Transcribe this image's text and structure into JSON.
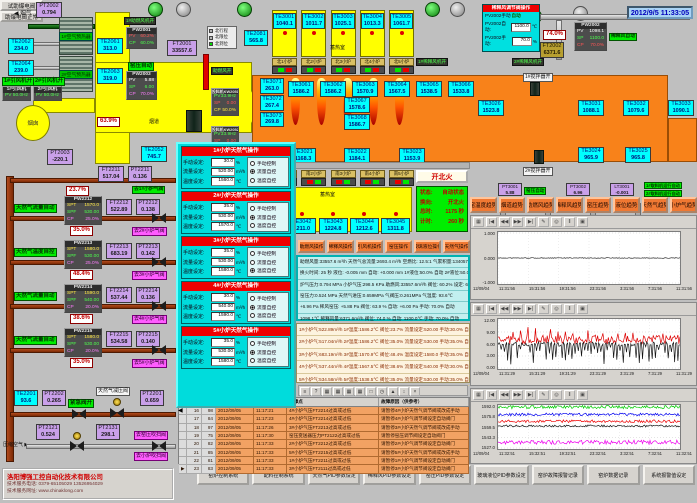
{
  "datetime": "2012/9/5 11:33:05",
  "top_left": {
    "pt2002": {
      "tag": "PT2002",
      "value": "0.794"
    },
    "smoke": "烟气",
    "exchanger1": "1#空气预热器",
    "exchanger2": "2#空气预热器",
    "te2062": {
      "tag": "TE2062",
      "value": "234.0"
    },
    "te2061": {
      "tag": "TE2061",
      "value": "313.0"
    },
    "te2064": {
      "tag": "TE2064",
      "value": "239.0"
    },
    "te2063": {
      "tag": "TE2063",
      "value": "319.0"
    },
    "fan1_run": "1#引风机开",
    "fan2_run": "2#引风机开",
    "fan1": {
      "title": "1#引风机",
      "k": "PV",
      "v": "50.0Hz"
    },
    "fan2": {
      "title": "2#引风机",
      "k": "PV",
      "v": "50.0Hz"
    },
    "chimney": "烟囱",
    "pt2003": {
      "tag": "PT2003",
      "value": "-220.1"
    },
    "comb_fan_run": "1#助燃风机开",
    "pw2001": {
      "title": "PW2001",
      "k1": "PV",
      "v1": "60.2%",
      "k2": "CP",
      "v2": "60.0%"
    },
    "kiln_auto": "窑压自动",
    "pw2003": {
      "title": "PW2003",
      "k1": "PV",
      "v1": "5.88",
      "k2": "SP",
      "v2": "6.00",
      "k3": "CP",
      "v3": "70.0%"
    },
    "ft2001": {
      "tag": "FT2001",
      "value": "33557.6"
    },
    "te2081": {
      "tag": "TE2081",
      "value": "565.8"
    },
    "damper": "63.9%",
    "flue": "烟道",
    "te2052": {
      "tag": "TE2052",
      "value": "745.7"
    },
    "legend": [
      {
        "label": "北行程",
        "c": "sq-gray"
      },
      {
        "label": "北限位",
        "c": "sq-gray"
      },
      {
        "label": "北到位",
        "c": "sq-green"
      }
    ],
    "comb_open": "助燃风开",
    "feeder1": {
      "title": "投料机KW2051",
      "k1": "PV",
      "v1": "33.9Hz",
      "k2": "SP",
      "v2": "0.00",
      "k3": "CP",
      "v3": "50.0%"
    },
    "feeder2": {
      "title": "投料机KW2052",
      "k1": "PV",
      "v1": "33.9Hz",
      "k2": "SP",
      "v2": "0.00",
      "k3": "CP",
      "v3": "50.0%"
    }
  },
  "furnace": {
    "regen_label": "蓄热室",
    "regen_top": [
      {
        "tag": "TE3001",
        "value": "1040.1"
      },
      {
        "tag": "TE3002",
        "value": "1011.7"
      },
      {
        "tag": "TE3003",
        "value": "1025.1"
      },
      {
        "tag": "TE3004",
        "value": "1013.3"
      },
      {
        "tag": "TE3005",
        "value": "1061.7"
      }
    ],
    "ports_north": [
      "北1小炉",
      "北2小炉",
      "北3小炉",
      "北4小炉",
      "北5小炉"
    ],
    "ports_south": [
      "南1小炉",
      "南2小炉",
      "南3小炉",
      "南4小炉",
      "南5小炉"
    ],
    "te_left": [
      {
        "tag": "TE3071",
        "value": "263.0"
      },
      {
        "tag": "TE3072",
        "value": "267.4"
      },
      {
        "tag": "TE3073",
        "value": "269.8"
      }
    ],
    "te_row": [
      {
        "tag": "TE3061",
        "value": "1586.2"
      },
      {
        "tag": "TE3062",
        "value": "1586.2"
      },
      {
        "tag": "TE3063",
        "value": "1570.9"
      },
      {
        "tag": "TE3064",
        "value": "1567.5"
      },
      {
        "tag": "TE3065",
        "value": "1538.5"
      },
      {
        "tag": "TE3066",
        "value": "1533.8"
      }
    ],
    "te_stack": [
      {
        "tag": "TE3067",
        "value": "1578.6"
      },
      {
        "tag": "TE3068",
        "value": "1586.7"
      }
    ],
    "te_right": [
      {
        "tag": "TE3026",
        "value": "1523.8"
      },
      {
        "tag": "TE3031",
        "value": "1088.1"
      },
      {
        "tag": "TE3032",
        "value": "1079.6"
      },
      {
        "tag": "TE3033",
        "value": "1090.1"
      }
    ],
    "te3024": {
      "tag": "TE3024",
      "value": "965.9"
    },
    "te3025": {
      "tag": "TE3025",
      "value": "965.8"
    },
    "te_low": [
      {
        "tag": "TE3021",
        "value": "1168.3"
      },
      {
        "tag": "TE3022",
        "value": "1184.1"
      },
      {
        "tag": "TE3023",
        "value": "1153.9"
      }
    ],
    "regen_bottom": [
      {
        "tag": "TE3041",
        "value": "1209.6"
      },
      {
        "tag": "TE3042",
        "value": "1211.0"
      },
      {
        "tag": "TE3043",
        "value": "1224.8"
      },
      {
        "tag": "TE3044",
        "value": "1212.6"
      },
      {
        "tag": "TE3045",
        "value": "1311.8"
      }
    ],
    "fire_btn": "开北火",
    "status": [
      {
        "k": "状态:",
        "v": "自动状态"
      },
      {
        "k": "换向:",
        "v": "开北火"
      },
      {
        "k": "总时:",
        "v": "1175 秒"
      },
      {
        "k": "计时:",
        "v": "260 秒"
      }
    ],
    "dilution1_run": "1#稀释风机开",
    "dilution2_run": "2#稀释风机开",
    "stir1": "1#搅拌器开",
    "stir2": "2#搅拌器开",
    "pt3001": {
      "tag": "PT3001",
      "value": "5.88"
    },
    "pt3002": {
      "tag": "PT3002",
      "value": "6.96"
    },
    "lt3001": {
      "tag": "LT3001",
      "value": "-0.001"
    },
    "kiln_auto2": "窑压自动",
    "taker1": "1#取料机运行自动",
    "taker2": "2#取料机运行自动"
  },
  "dilution": {
    "title": "稀释风调节阀操作",
    "mode_label": "PV2002手动",
    "mode_value": "自动",
    "auto_label": "PV2002自动:",
    "auto_value": "1100.0",
    "auto_unit": "℃",
    "man_label": "PV2002手动:",
    "man_value": "70.0",
    "man_unit": "%",
    "pct": "74.0%",
    "ft2002": {
      "tag": "FT2002",
      "value": "6371.6"
    },
    "pw2002": {
      "title": "PW2002",
      "k1": "PV",
      "v1": "1098.1",
      "k2": "SP",
      "v2": "1100.0",
      "k3": "CP",
      "v3": "70.0%"
    },
    "auto_tag": "稀释风自动",
    "btn_test": "试助爆电阀",
    "btn_ok": "助爆电阀正常"
  },
  "gas": {
    "line1": {
      "ft": {
        "tag": "FT2211",
        "value": "517.04"
      },
      "pt": {
        "tag": "PT2211",
        "value": "0.136"
      },
      "dest": "去1#小炉气阀",
      "pct_top": "23.7%"
    },
    "rows": [
      {
        "label": "天然气流量自动",
        "stack": {
          "title": "PW2212",
          "k1": "SPT",
          "v1": "1570.0",
          "k2": "SPF",
          "v2": "530.00",
          "k3": "CP",
          "v3": "25.0%"
        },
        "ft_tag": "FT2212",
        "ft_val": "522.89",
        "pt_tag": "PT2212",
        "pt_val": "0.138",
        "pct": "35.0%",
        "dest": "去2#小炉气阀"
      },
      {
        "label": "天然气温度自控",
        "stack": {
          "title": "PW2213",
          "k1": "SPT",
          "v1": "1580.0",
          "k2": "SPF",
          "v2": "530.00",
          "k3": "CP",
          "v3": "25.0%"
        },
        "ft_tag": "FT2213",
        "ft_val": "683.19",
        "pt_tag": "PT2213",
        "pt_val": "0.142",
        "pct": "48.4%",
        "dest": "去3#小炉气阀"
      },
      {
        "label": "天然气流量自动",
        "stack": {
          "title": "PW2214",
          "k1": "SPT",
          "v1": "1590.0",
          "k2": "SPF",
          "v2": "540.00",
          "k3": "CP",
          "v3": "20.0%"
        },
        "ft_tag": "FT2214",
        "ft_val": "537.44",
        "pt_tag": "PT2214",
        "pt_val": "0.136",
        "pct": "38.6%",
        "dest": "去4#小炉气阀"
      },
      {
        "label": "天然气流量自动",
        "stack": {
          "title": "PW2215",
          "k1": "SPT",
          "v1": "1580.0",
          "k2": "SPF",
          "v2": "530.00",
          "k3": "CP",
          "v3": "20.0%"
        },
        "ft_tag": "FT2215",
        "ft_val": "534.58",
        "pt_tag": "PT2215",
        "pt_val": "0.140",
        "pct": "35.0%",
        "dest": "去5#小炉气阀"
      }
    ],
    "te2201": {
      "tag": "TE2201",
      "value": "93.6"
    },
    "pt2202": {
      "tag": "PT2202",
      "value": "0.265"
    },
    "emerg": "紧急阀开",
    "pcv_label": "天然气减压阀",
    "pt2201": {
      "tag": "PT2201",
      "value": "0.659"
    },
    "air_label": "压缩空气",
    "pt2121": {
      "tag": "PT2121",
      "value": "0.524"
    },
    "pt2131": {
      "tag": "PT2131",
      "value": "298.1"
    },
    "air_dest1": "去窑压吹扫阀",
    "air_dest2": "去小炉吹扫阀"
  },
  "popup": {
    "f1": "手动设定:",
    "f2": "流量设定:",
    "f3": "温度设定:",
    "u1": "%",
    "u2": "m³/h",
    "u3": "℃",
    "r1": "手动控制",
    "r2": "流量自控",
    "r3": "温度自控",
    "panels": [
      {
        "title": "1#小炉天然气操作",
        "manual": "30.0",
        "flow": "520.00",
        "temp": "1560.0",
        "m0": "",
        "m1": "sel",
        "m2": ""
      },
      {
        "title": "2#小炉天然气操作",
        "manual": "35.0",
        "flow": "530.00",
        "temp": "1570.0",
        "m0": "",
        "m1": "sel",
        "m2": ""
      },
      {
        "title": "3#小炉天然气操作",
        "manual": "35.0",
        "flow": "530.00",
        "temp": "1580.0",
        "m0": "",
        "m1": "",
        "m2": "sel"
      },
      {
        "title": "4#小炉天然气操作",
        "manual": "30.0",
        "flow": "540.00",
        "temp": "1590.0",
        "m0": "",
        "m1": "sel",
        "m2": ""
      },
      {
        "title": "5#小炉天然气操作",
        "manual": "35.0",
        "flow": "530.00",
        "temp": "1580.0",
        "m0": "",
        "m1": "sel",
        "m2": ""
      }
    ]
  },
  "center": {
    "op_buttons": [
      "助燃风操作",
      "稀释风操作",
      "引风机操作",
      "窑压操作",
      "玻璃液位操作",
      "天然气操作"
    ],
    "info_lines": [
      "助燃风量:33557.6 m³/h  天然气总流量:2693.4 m³/h  空燃比: 12.5:1  气累积量:134057.7m³",
      "换火时间: 25 秒   液位: -0.005 mm  自动: +0.000 mm  1#液位:50.0% 自动  2#液位:50.0% 自动",
      "炉气压力:0.794 MPa  小炉气压:298.5 KPa  助燃风:33557.6m³/h  阀位: 60.2%  设定: 60.0%",
      "窑压力:0.524 MPa  天然气进压:0.659MPa  气阀压:0.261MPa  气温度: 93.6℃",
      "+6.96 Pa  稀风窑压: +5.88 Pa  阀位: 63.9 %  自动: +6.00 Pa  手动: 70.0%  自动",
      "1098.1℃  稀释风量:6371.6m³/h  阀位: 74.0 %  自动: 1100.0℃  手动: 70.0%  自动"
    ],
    "furnace_lines": [
      "1#小炉气:522.89m³/h  1#温度:1586.2℃  阀位:23.7%  流量设定:520.00  手动:30.0%  自动",
      "2#小炉气:517.04m³/h  2#温度:1586.2℃  阀位:35.0%  流量设定:530.00  手动:35.0%  自动",
      "3#小炉气:683.19m³/h  3#温度:1570.9℃  阀位:48.4%  温度设定:1580.0  手动:35.0%  自动",
      "4#小炉气:537.44m³/h  4#温度:1567.5℃  阀位:38.6%  流量设定:540.00  手动:30.0%  自动",
      "5#小炉气:534.58m³/h  5#温度:1538.5℃  阀位:35.0%  流量设定:530.00  手动:35.0%  自动"
    ]
  },
  "alarm": {
    "icons": [
      "≡",
      "?",
      "▦",
      "▦",
      "▦",
      "▦",
      "□",
      "◷",
      "▲",
      "↕",
      "×"
    ],
    "col_fault": "故障点",
    "col_reason": "故障原因（供参考）",
    "rows": [
      {
        "mark": "",
        "i": "16",
        "code": "98",
        "date": "2012/09/05",
        "time": "11:17:21",
        "fault": "4#小炉气压FT2214过高或过低",
        "reason": "请暂停4#小炉天然气调节阀或改成手动"
      },
      {
        "mark": "",
        "i": "17",
        "code": "84",
        "date": "2012/09/05",
        "time": "11:17:23",
        "fault": "4#小炉气压FT2214过高或过低",
        "reason": "请暂停4#小炉气调节阀设定自动阀门"
      },
      {
        "mark": "",
        "i": "18",
        "code": "97",
        "date": "2012/09/05",
        "time": "11:17:26",
        "fault": "3#小炉气压FT2213过高或过低",
        "reason": "请暂停3#小炉天然气调节阀或改成手动"
      },
      {
        "mark": "",
        "i": "19",
        "code": "75",
        "date": "2012/09/05",
        "time": "11:17:30",
        "fault": "窑压变送器压力PT2122过高或过低",
        "reason": "请暂停窑压调节阀设定自动阀门"
      },
      {
        "mark": "",
        "i": "20",
        "code": "82",
        "date": "2012/09/05",
        "time": "11:17:33",
        "fault": "2#小炉气压FT2212过高或过低",
        "reason": "请暂停2#小炉气调节阀设定自动阀门"
      },
      {
        "mark": "",
        "i": "21",
        "code": "85",
        "date": "2012/09/05",
        "time": "11:17:33",
        "fault": "5#小炉气压FT2215过高或过低",
        "reason": "请暂停5#小炉天然气调节阀或改成手动"
      },
      {
        "mark": "",
        "i": "22",
        "code": "81",
        "date": "2012/09/05",
        "time": "11:17:33",
        "fault": "1#小炉气压FT2211过高或过低",
        "reason": "请暂停1#小炉气调节阀设定自动阀门"
      },
      {
        "mark": "▶",
        "i": "23",
        "code": "83",
        "date": "2012/09/05",
        "time": "11:17:33",
        "fault": "3#小炉气压FT2111过高或过低",
        "reason": "请暂停3#小炉气调节阀设定自动阀门"
      }
    ]
  },
  "trend_buttons": [
    "窑温度趋势",
    "烟道趋势",
    "助燃风趋势",
    "稀释风趋势",
    "窑压趋势",
    "液位趋势",
    "天然气趋势",
    "小炉气趋势"
  ],
  "chart_icons": [
    "▦",
    "|◀",
    "◀◀",
    "▶▶",
    "▶|",
    "✎",
    "◎",
    "‖",
    "▣"
  ],
  "nav_buttons": [
    "窑炉控制系统",
    "配料控制系统",
    "天然气PID参数设定",
    "稀释风PID参数设定",
    "窑压PID参数设定",
    "玻璃液位PID参数设定",
    "窑炉故障报警记录",
    "窑炉数据记录",
    "系统报警值设定"
  ],
  "company": {
    "name": "洛阳博强工控自动化技术有限公司",
    "phone": "技术服务电话: 0379-65105029  13526954029",
    "web": "技术服务网址: www.chinaklong.com"
  },
  "chart_data": [
    {
      "type": "line",
      "title": "窑压趋势",
      "y_ticks": [
        "1.000",
        "0.000",
        "-1.000"
      ],
      "ylim": [
        -1,
        1
      ],
      "x_date": "12/09/04",
      "x_ticks": [
        "11:31:56",
        "15:31:56",
        "19:31:56",
        "23:31:56",
        "3:31:56",
        "7:31:56",
        "11:31:56"
      ],
      "grid": true,
      "legend_position": "none",
      "series": [
        {
          "name": "窑压偏差",
          "color": "#303030",
          "base": 0,
          "amp": 0.015
        }
      ]
    },
    {
      "type": "line",
      "title": "窑压/烟道趋势",
      "y_ticks": [
        "12.00",
        "9.00",
        "6.00",
        "3.00",
        "0.00"
      ],
      "ylim": [
        0,
        12
      ],
      "x_date": "12/09/04",
      "x_ticks": [
        "11:31:29",
        "15:31:29",
        "19:31:29",
        "23:31:29",
        "3:31:29",
        "7:31:29",
        "11:31:29"
      ],
      "grid": true,
      "legend_position": "none",
      "series": [
        {
          "name": "红线",
          "color": "#dd0000",
          "base": 7.0,
          "amp": 1.0,
          "spike": 2.5,
          "spike_every": 7
        },
        {
          "name": "黑线",
          "color": "#141414",
          "base": 6.0,
          "amp": 0.5,
          "spike": -4.5,
          "spike_every": 3
        }
      ]
    },
    {
      "type": "line",
      "title": "小炉温度趋势",
      "y_ticks": [
        "1592.0",
        "1575.8",
        "1559.5",
        "1543.3",
        "1527.0"
      ],
      "ylim": [
        1527,
        1592
      ],
      "x_date": "12/09/04",
      "x_ticks": [
        "11:32:51",
        "15:32:51",
        "19:32:51",
        "23:32:51",
        "3:32:51",
        "7:32:51",
        "11:32:51"
      ],
      "grid": true,
      "legend_position": "none",
      "series": [
        {
          "name": "TE3061",
          "color": "#00cc00",
          "base": 1589,
          "amp": 2.5
        },
        {
          "name": "TE3063",
          "color": "#0000ee",
          "base": 1578,
          "amp": 2.0
        },
        {
          "name": "TE3062",
          "color": "#ee0000",
          "base": 1568,
          "amp": 2.0
        },
        {
          "name": "TE3064",
          "color": "#141414",
          "base": 1561,
          "amp": 1.5
        },
        {
          "name": "TE3065",
          "color": "#ee00ee",
          "base": 1537,
          "amp": 3.0
        }
      ]
    }
  ]
}
